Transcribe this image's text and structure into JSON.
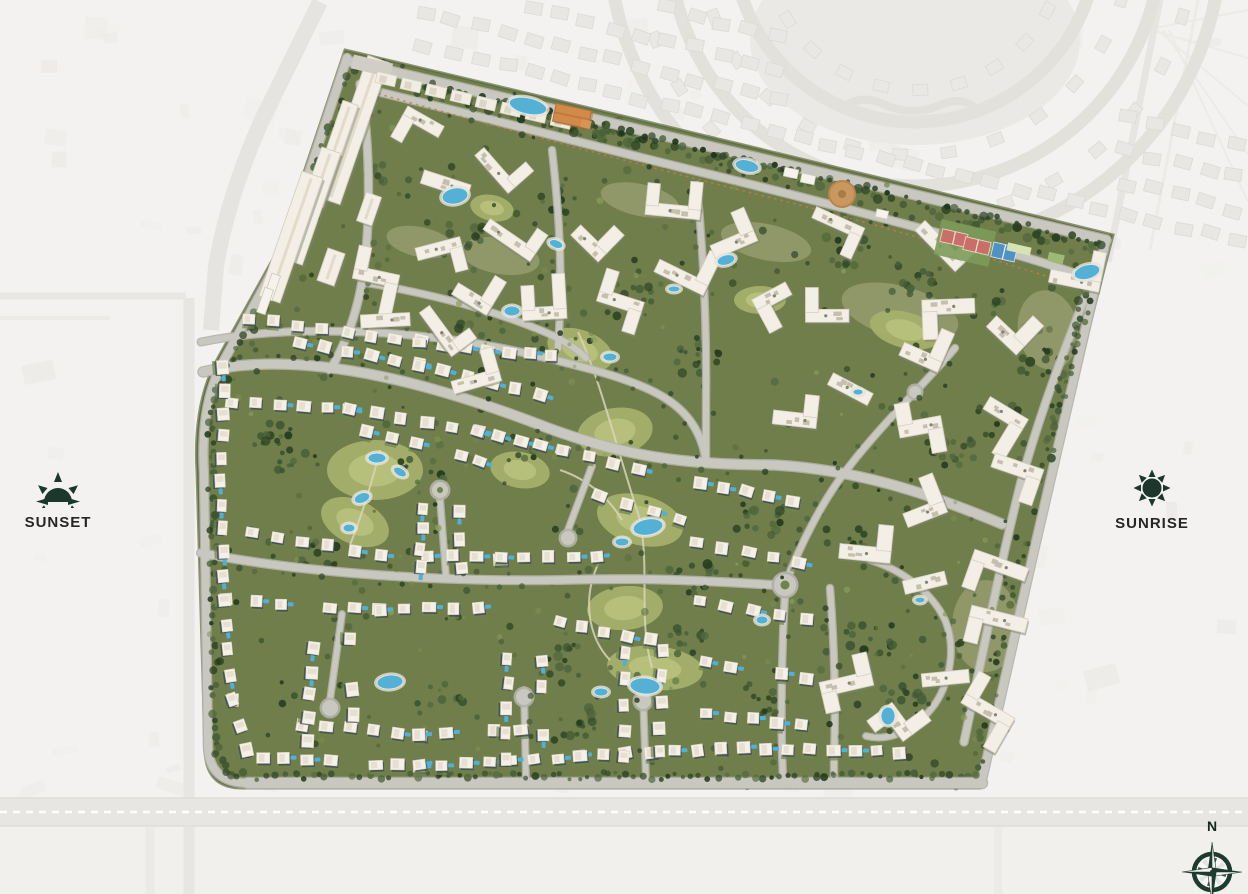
{
  "page": {
    "background": "#f3f2f0"
  },
  "legend": {
    "sunset_label": "SUNSET",
    "sunrise_label": "SUNRISE",
    "compass_north_label": "N",
    "icon_color": "#1c382c",
    "label_color": "#262626"
  },
  "map": {
    "kind": "residential-masterplan-aerial",
    "colors": {
      "site_green": "#6f7e4a",
      "road_gray": "#c9c8c0",
      "building_white": "#f5f1e8",
      "pool_blue": "#55b0d6",
      "tennis_court_red": "#c96f68",
      "padel_court_blue": "#4f93c4",
      "clubhouse_orange": "#d28a4a",
      "plaza_tan": "#c9985f",
      "context_gray": "#eceae7"
    }
  }
}
